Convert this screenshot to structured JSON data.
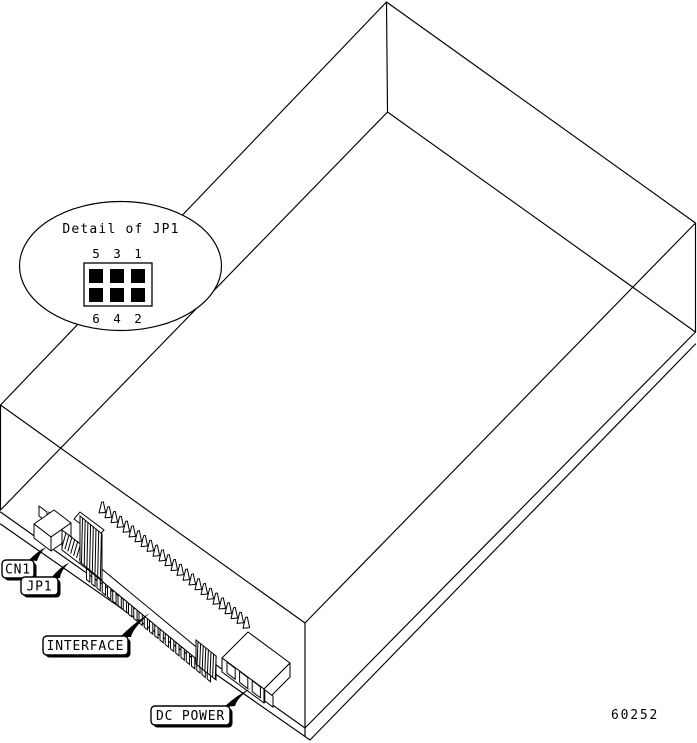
{
  "figure": {
    "background_color": "#ffffff",
    "line_color": "#000000",
    "part_number": "60252",
    "detail": {
      "title": "Detail of JP1",
      "top_pins": [
        "5",
        "3",
        "1"
      ],
      "bottom_pins": [
        "6",
        "4",
        "2"
      ]
    },
    "callouts": {
      "cn1": "CN1",
      "jp1": "JP1",
      "interface": "INTERFACE",
      "dc_power": "DC POWER"
    }
  }
}
